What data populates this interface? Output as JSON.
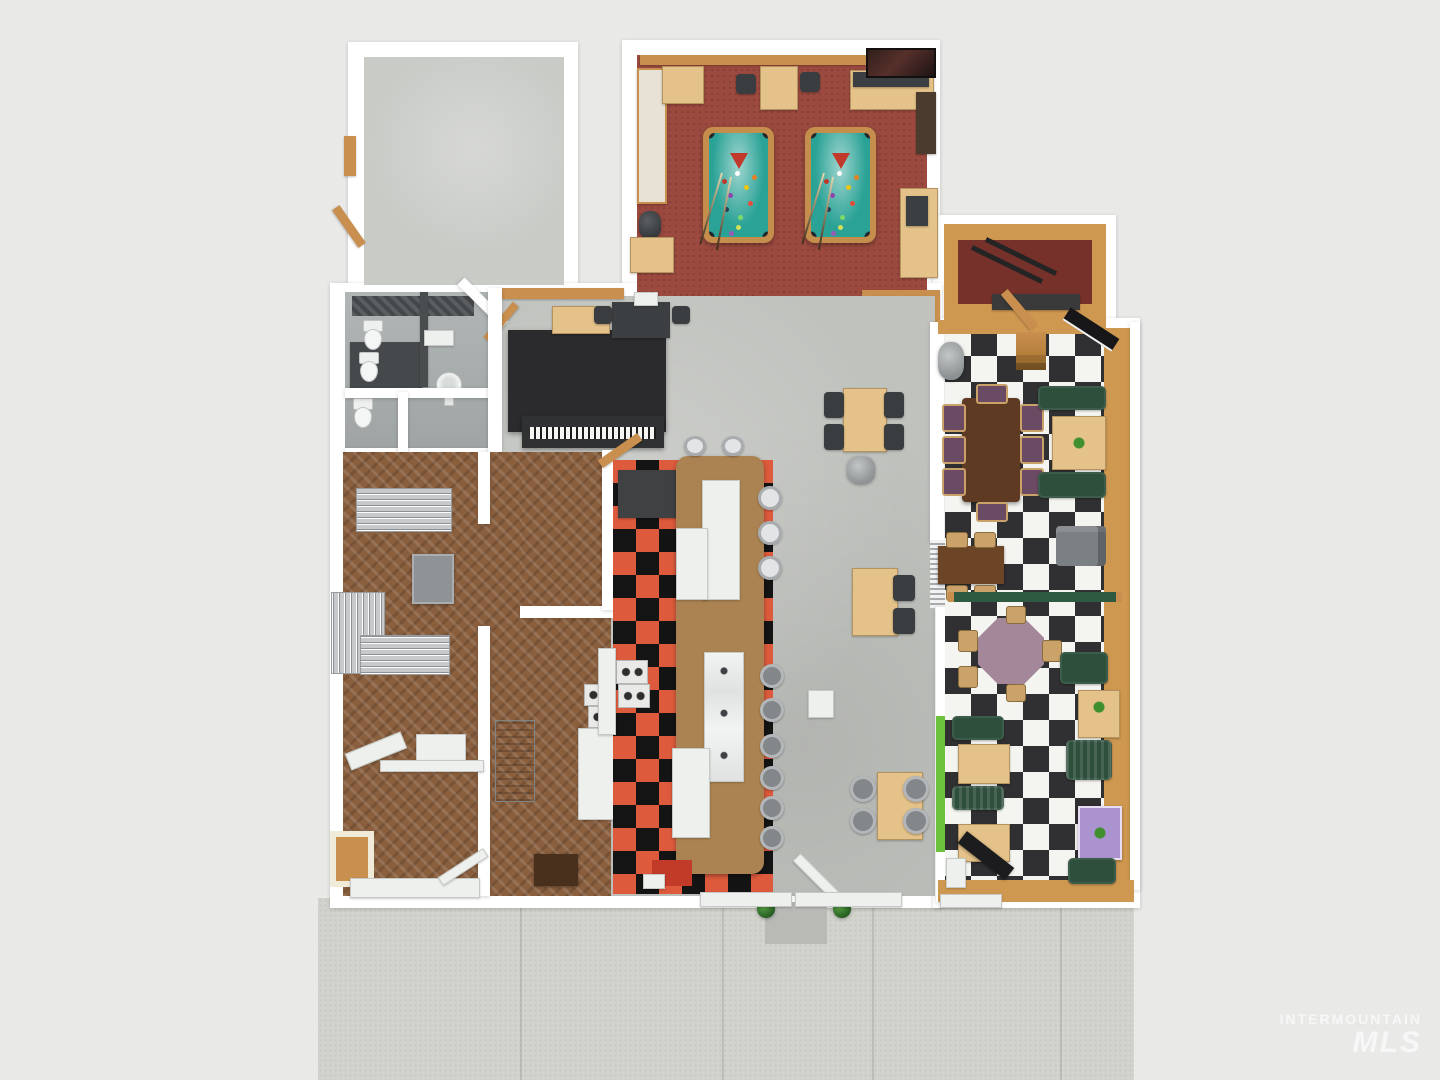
{
  "watermark": {
    "line1": "INTERMOUNTAIN",
    "line2": "MLS"
  },
  "colors": {
    "bg": "#e9e9e8",
    "wall": "#ffffff",
    "sidewalk": "#d3d3cd",
    "concrete": "#c0c2be",
    "concreteLight": "#c9cbc7",
    "poolFloor": "#9c4a3f",
    "poolFelt": "#2aa295",
    "poolWood": "#c68e4c",
    "woodTan": "#c98f4e",
    "tableTan": "#e4c289",
    "counterBrown": "#ab8352",
    "checkerDark": "#303032",
    "checkerLight": "#f4f4f1",
    "kitchenOrange": "#dd5a3c",
    "kitchenBlack": "#141414",
    "parquet": "#8a5f3e",
    "boothGreen": "#2e4f3c",
    "accentGreen": "#6cc13d",
    "dividerGreen": "#2f5a42",
    "chairDark": "#3a3d40",
    "chairPurple": "#6b4a63",
    "stoolGray": "#83878a",
    "couchGray": "#7b8084",
    "stainless": "#b3b7ba",
    "tanWall": "#cf9850",
    "darkRedFloor": "#76312a",
    "stageBlack": "#2b2b2d",
    "bigTableBrown": "#5f3a22",
    "octagonMauve": "#a4889a",
    "purpleTable": "#ab93cf",
    "tileGray": "#a8adad",
    "stallDark": "#46494b",
    "redMat": "#c23a28",
    "plantGreen": "#2f7a2c",
    "railWood": "#b5793c",
    "watermark": "#ffffff"
  },
  "scene": {
    "type": "3d-floor-plan-top-view",
    "pool_table_count": 2,
    "rooms": [
      {
        "name": "storage-room-top-left",
        "floor": "concrete"
      },
      {
        "name": "game-room",
        "floor": "red-carpet",
        "features": [
          "pool-table",
          "pool-table",
          "bench",
          "bar-counter",
          "picture",
          "trash-can"
        ]
      },
      {
        "name": "back-room-top-right",
        "floor": "dark-red",
        "features": [
          "ramp-rails",
          "mat"
        ]
      },
      {
        "name": "restrooms",
        "floor": "gray-tile",
        "features": [
          "toilet",
          "toilet",
          "toilet",
          "toilet",
          "pedestal-sink",
          "stall"
        ]
      },
      {
        "name": "stage-area",
        "floor": "concrete",
        "features": [
          "stage",
          "piano",
          "cabinet",
          "table"
        ]
      },
      {
        "name": "main-dining-area",
        "floor": "concrete",
        "features": [
          "table",
          "table",
          "table",
          "trash-can"
        ]
      },
      {
        "name": "diner-booth-area",
        "floor": "black-white-checker",
        "features": [
          "large-table",
          "booths",
          "octagon-table",
          "couch",
          "purple-table",
          "divider"
        ]
      },
      {
        "name": "kitchen-counter-line",
        "floor": "orange-black-checker",
        "features": [
          "lunch-counter",
          "stools",
          "fridge",
          "triple-sink",
          "cooktops",
          "red-mat"
        ]
      },
      {
        "name": "storage-prep-rooms",
        "floor": "parquet",
        "features": [
          "wire-racks",
          "gray-cabinet",
          "stainless-machine",
          "bookcase",
          "cooktops"
        ]
      },
      {
        "name": "sidewalk-entry",
        "floor": "speckled-concrete",
        "features": [
          "open-door",
          "doormat",
          "plants",
          "window-sills"
        ]
      }
    ]
  }
}
